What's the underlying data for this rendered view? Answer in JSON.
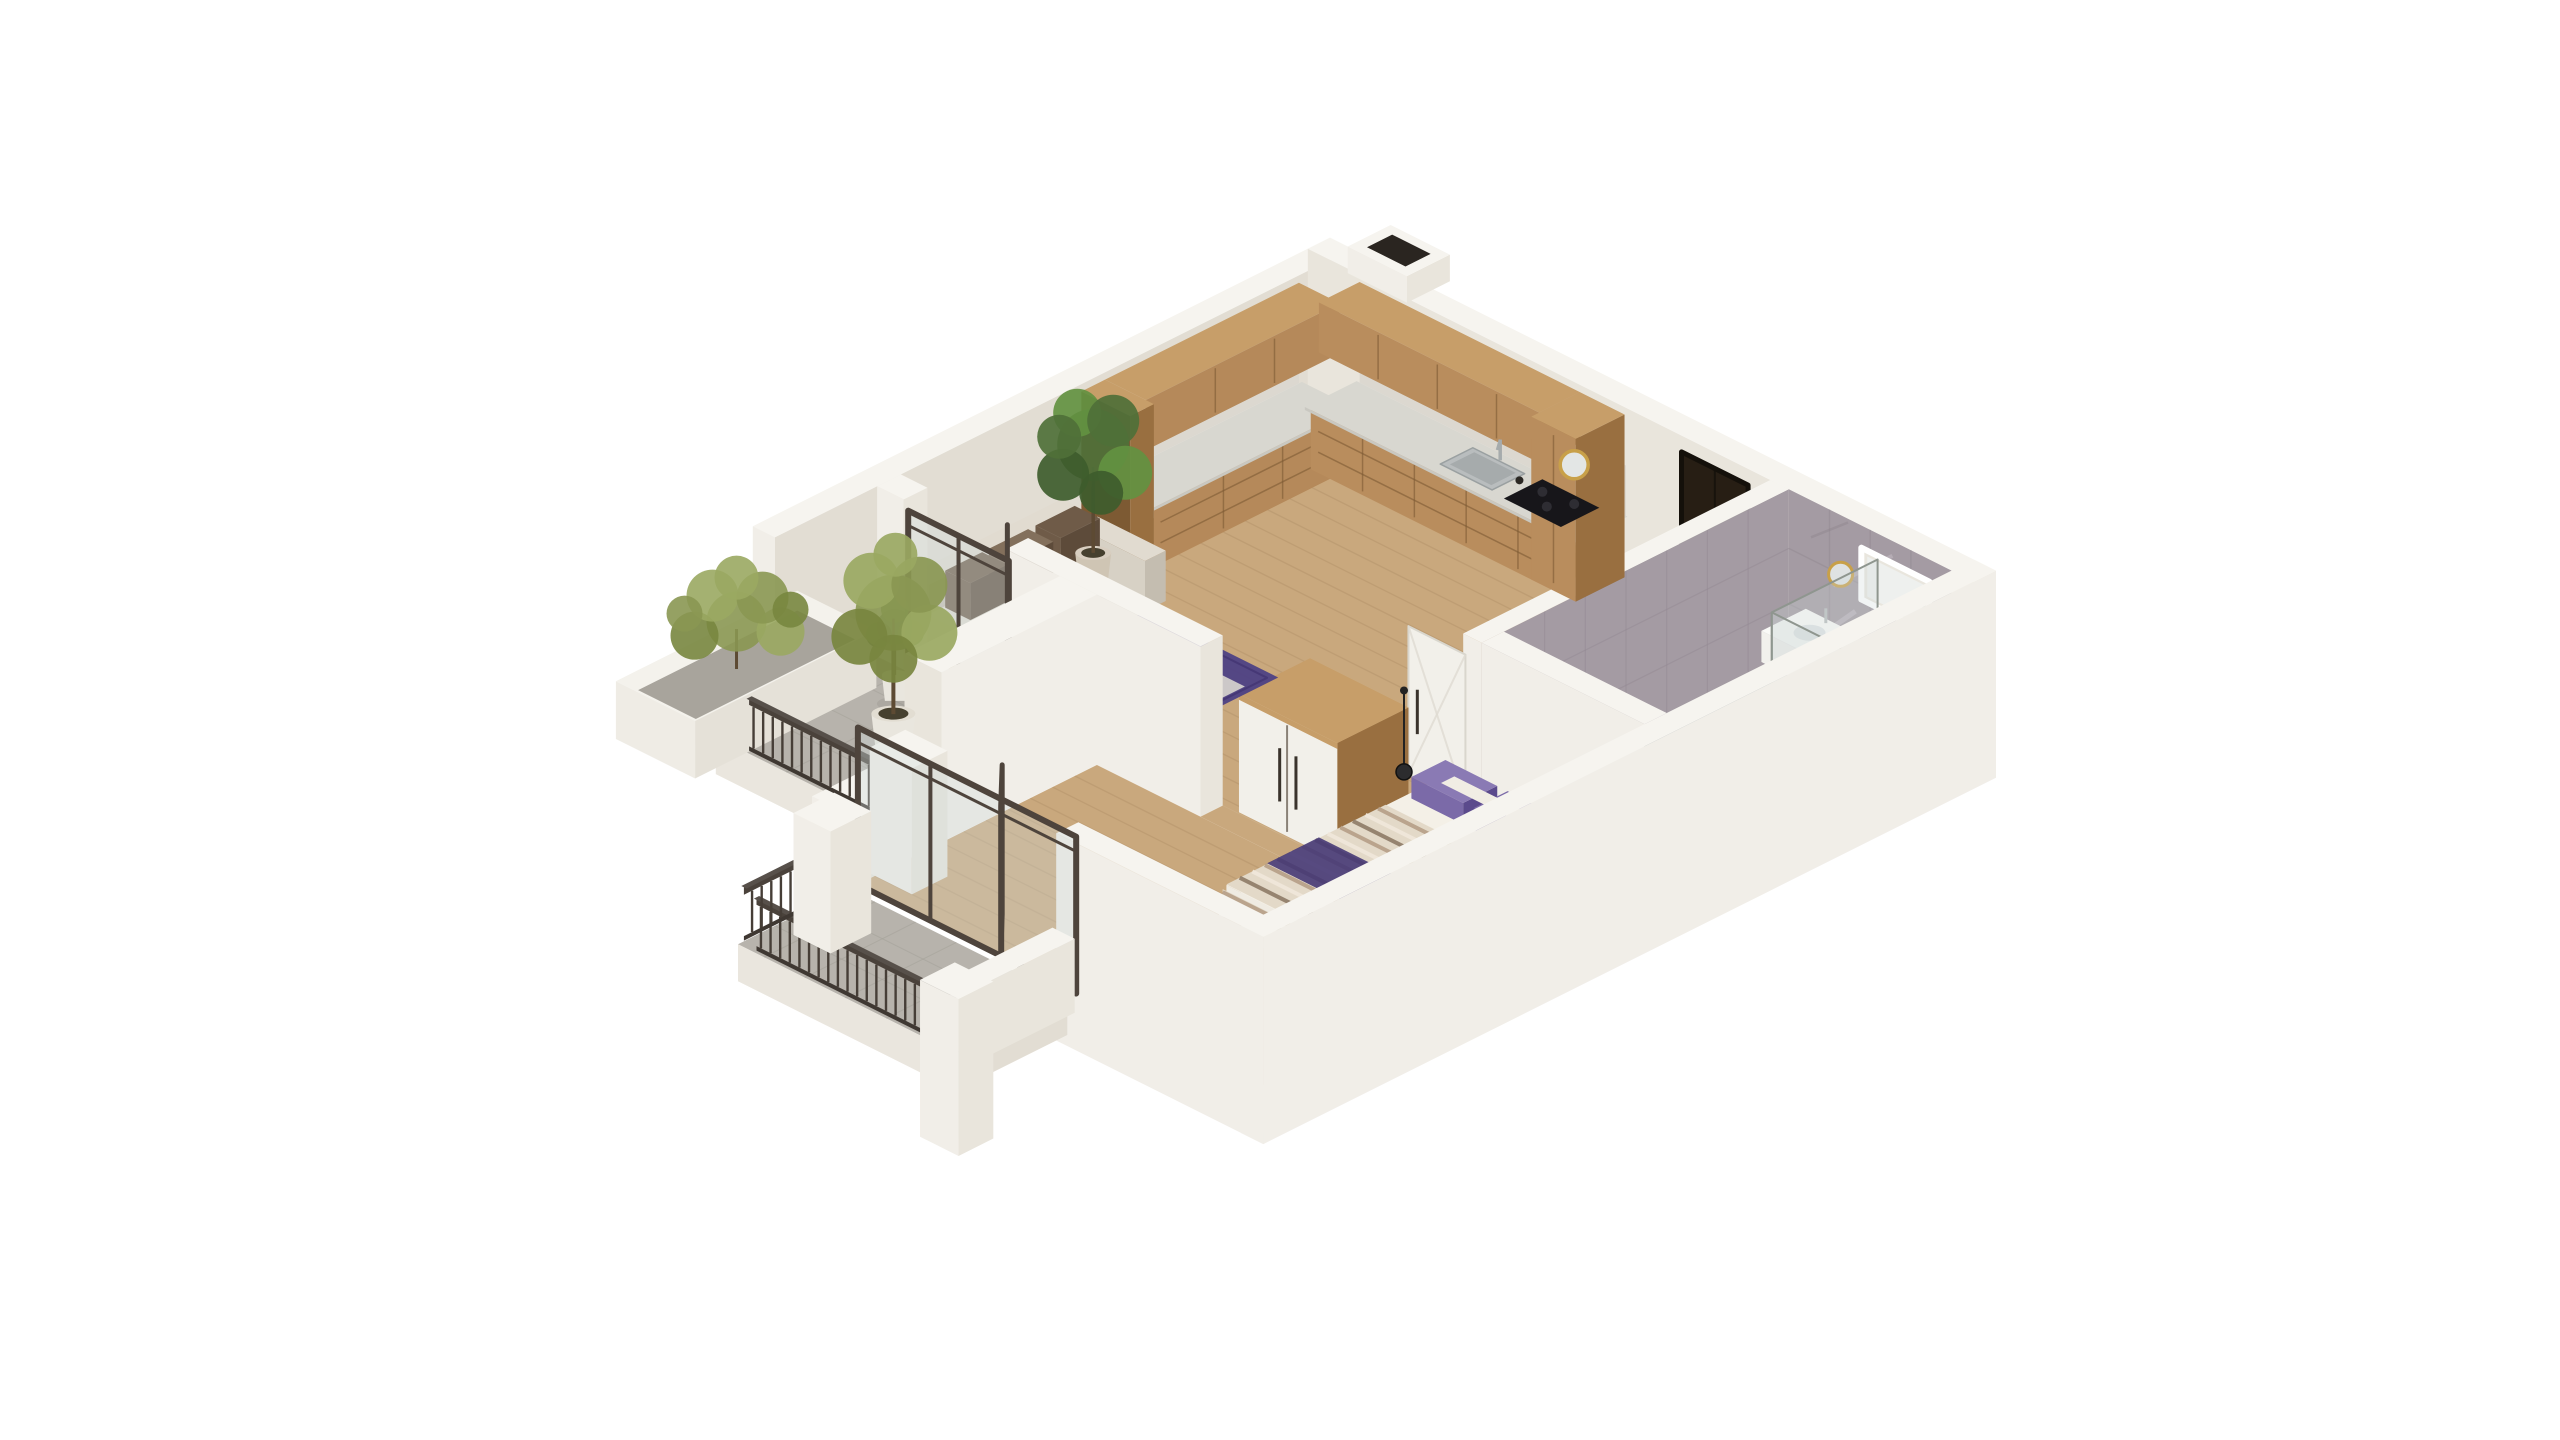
{
  "scene": {
    "description": "Isometric 3D cutaway floor plan render of a one-bedroom apartment with kitchen, living room, bedroom, bathroom and two balconies",
    "background": "#ffffff",
    "colors": {
      "wallTop": "#f6f4ef",
      "wallBright": "#f1eee8",
      "wallMid": "#e9e5dc",
      "wallInner": "#e2ddd3",
      "wallShadow": "#d9d4c9",
      "slab": "#eae6de",
      "floorWood": "#c9a87d",
      "floorWoodLine": "#b3916a",
      "balconyFloor": "#b7b3ac",
      "balconyLine": "#a5a19a",
      "bathFloor": "#73838b",
      "bathLine": "#5d6d75",
      "bathTray": "#7d8e95",
      "marble": "#a49ba3",
      "marbleStreakLight": "#c9c2ca",
      "marbleStreakDark": "#8b8189",
      "marbleLine": "#938a93",
      "woodFront": "#b5895a",
      "woodFront2": "#b98d5d",
      "woodSide": "#996f40",
      "woodTop": "#c79e69",
      "woodDark": "#7d5a33",
      "counterTop": "#d8d7d0",
      "counterEdge": "#c9c8c1",
      "backsplash": "#dcd8d0",
      "steel": "#b9bdbe",
      "steelDark": "#a6abac",
      "cooktop": "#17161a",
      "gold": "#c8a049",
      "sofaBase": "#d7d1c5",
      "sofaTop": "#e1dbd0",
      "sofaShadow": "#c4bdb0",
      "cushionBrown": "#6f5b48",
      "cushionBrown2": "#83705c",
      "purple": "#5b4a8c",
      "purple2": "#7b6aa8",
      "purpleDeep": "#463876",
      "rug": "#4f4384",
      "rugLight": "#d9d6cf",
      "tableTop": "#f0efe9",
      "tableSide": "#d5d2c8",
      "bronze": "#55483c",
      "glass": "#cfd9d9",
      "glassFrame": "#4e443c",
      "doorDark": "#271e14",
      "doorDarkFrame": "#14100a",
      "whitePaint": "#f2f0ea",
      "fixtureWhite": "#f2f1ed",
      "railing": "#4a423b",
      "railingDark": "#3f3832",
      "green": "#4f7038",
      "greenLight": "#639141",
      "greenDark": "#3e5c2c",
      "olive": "#8a9752",
      "oliveLight": "#9aa862",
      "oliveDark": "#78863f",
      "trunk": "#5d4a33",
      "pot": "#cfc5b4",
      "potLight": "#e9e6de",
      "soil": "#46402f",
      "gravel": "#a8a49c",
      "blanketBase": "#e3d9c8",
      "blanketStripeA": "#b59d86",
      "blanketStripeB": "#8d7a66",
      "blanketStripeC": "#efe7da",
      "pendant": "#222222",
      "shadow": "#000000"
    },
    "objects": [
      {
        "name": "exterior-walls"
      },
      {
        "name": "ventilation-shaft"
      },
      {
        "name": "kitchen-cabinets"
      },
      {
        "name": "kitchen-sink"
      },
      {
        "name": "kitchen-cooktop"
      },
      {
        "name": "kitchen-mirror"
      },
      {
        "name": "entry-door"
      },
      {
        "name": "bathroom"
      },
      {
        "name": "bathroom-window"
      },
      {
        "name": "bathroom-vanity"
      },
      {
        "name": "bathroom-toilet"
      },
      {
        "name": "bathroom-bench"
      },
      {
        "name": "shower-glass"
      },
      {
        "name": "bathroom-door"
      },
      {
        "name": "hallway-wardrobe"
      },
      {
        "name": "sofa"
      },
      {
        "name": "area-rug"
      },
      {
        "name": "coffee-tables"
      },
      {
        "name": "indoor-plant"
      },
      {
        "name": "interior-wall"
      },
      {
        "name": "living-balcony-door"
      },
      {
        "name": "living-balcony"
      },
      {
        "name": "planter-box"
      },
      {
        "name": "balcony-tree"
      },
      {
        "name": "balcony-plant"
      },
      {
        "name": "balcony-railing"
      },
      {
        "name": "bed"
      },
      {
        "name": "pendant-lamp"
      },
      {
        "name": "bedroom-balcony-door"
      },
      {
        "name": "bedroom-balcony"
      }
    ]
  }
}
